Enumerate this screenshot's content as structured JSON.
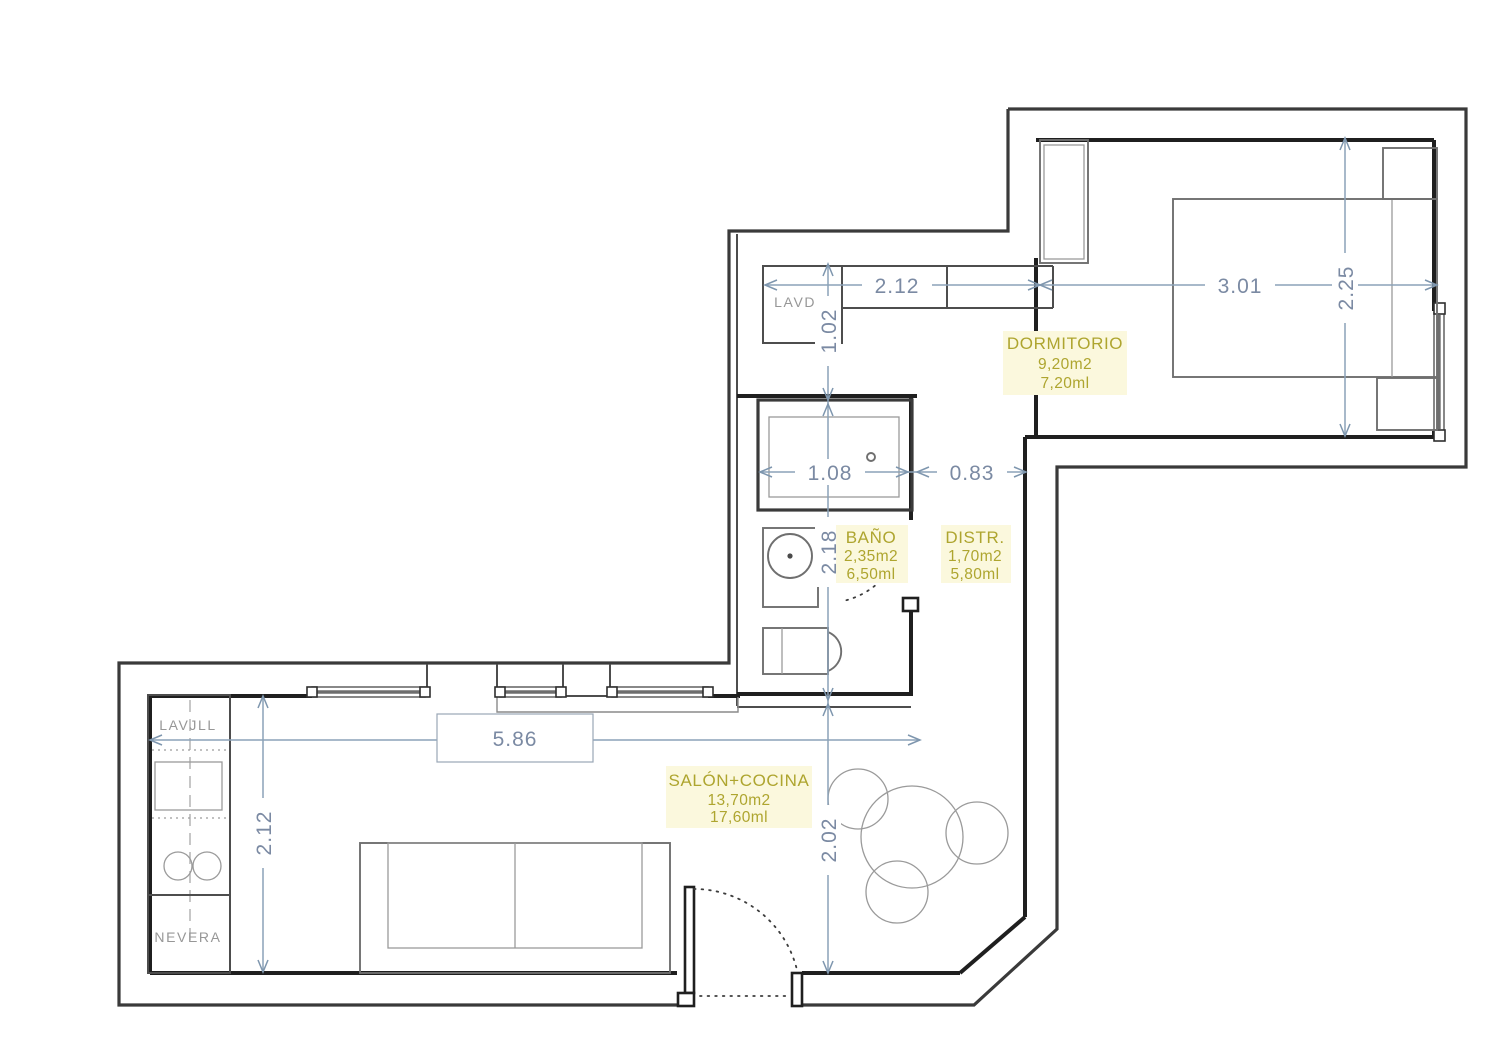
{
  "plan": {
    "rooms": {
      "dormitorio": {
        "name": "DORMITORIO",
        "area": "9,20m2",
        "perimeter": "7,20ml"
      },
      "bano": {
        "name": "BAÑO",
        "area": "2,35m2",
        "perimeter": "6,50ml"
      },
      "distribuidor": {
        "name": "DISTR.",
        "area": "1,70m2",
        "perimeter": "5,80ml"
      },
      "salon_cocina": {
        "name": "SALÓN+COCINA",
        "area": "13,70m2",
        "perimeter": "17,60ml"
      }
    },
    "appliances": {
      "lavadora": "LAVDR",
      "lavavajillas": "LAVJLL",
      "nevera": "NEVERA"
    },
    "dimensions": {
      "pasillo_ancho": "2.12",
      "dormitorio_ancho": "3.01",
      "dormitorio_fondo": "2.25",
      "lavadero_fondo": "1.02",
      "bano_fondo": "2.18",
      "ducha_ancho": "1.08",
      "distribuidor_ancho": "0.83",
      "salon_ancho": "5.86",
      "cocina_fondo": "2.12",
      "salon_fondo": "2.02"
    },
    "colors": {
      "wall": "#2d2d2d",
      "furniture": "#6f6f6f",
      "dimension_line": "#8ba2b8",
      "dimension_text": "#7b8aa3",
      "room_label": "#aea52f",
      "appliance_label": "#979797",
      "label_background": "#fbf8dd"
    }
  }
}
